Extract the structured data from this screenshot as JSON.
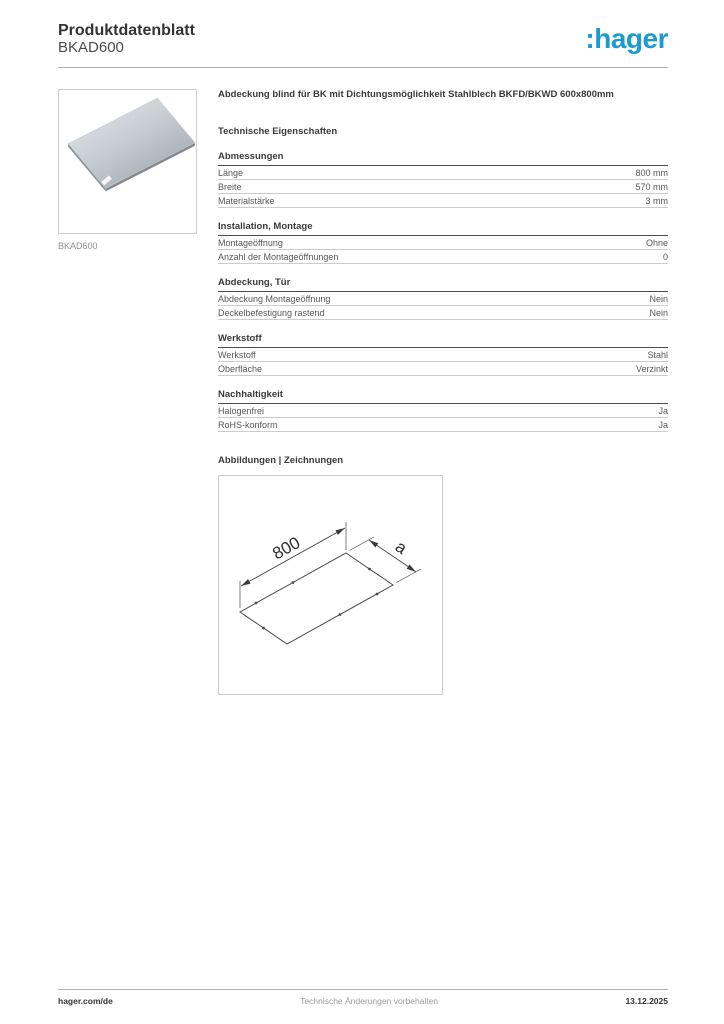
{
  "header": {
    "title": "Produktdatenblatt",
    "product_code": "BKAD600",
    "logo_text": ":hager"
  },
  "colors": {
    "logo_blue": "#1e9ad3",
    "text_dark": "#3c3c3c",
    "text_gray": "#9a9a9a",
    "rule_light": "#cccccc",
    "rule_dark": "#4d4d4d"
  },
  "product_image": {
    "caption": "BKAD600"
  },
  "description": "Abdeckung blind für BK mit Dichtungsmöglichkeit Stahlblech BKFD/BKWD 600x800mm",
  "tech_heading": "Technische Eigenschaften",
  "spec_sections": [
    {
      "title": "Abmessungen",
      "rows": [
        {
          "label": "Länge",
          "value": "800 mm"
        },
        {
          "label": "Breite",
          "value": "570 mm"
        },
        {
          "label": "Materialstärke",
          "value": "3 mm"
        }
      ]
    },
    {
      "title": "Installation, Montage",
      "rows": [
        {
          "label": "Montageöffnung",
          "value": "Ohne"
        },
        {
          "label": "Anzahl der Montageöffnungen",
          "value": "0"
        }
      ]
    },
    {
      "title": "Abdeckung, Tür",
      "rows": [
        {
          "label": "Abdeckung Montageöffnung",
          "value": "Nein"
        },
        {
          "label": "Deckelbefestigung rastend",
          "value": "Nein"
        }
      ]
    },
    {
      "title": "Werkstoff",
      "rows": [
        {
          "label": "Werkstoff",
          "value": "Stahl"
        },
        {
          "label": "Oberfläche",
          "value": "Verzinkt"
        }
      ]
    },
    {
      "title": "Nachhaltigkeit",
      "rows": [
        {
          "label": "Halogenfrei",
          "value": "Ja"
        },
        {
          "label": "RoHS-konform",
          "value": "Ja"
        }
      ]
    }
  ],
  "drawings": {
    "heading": "Abbildungen | Zeichnungen",
    "length_label": "800",
    "width_label": "a"
  },
  "footer": {
    "left": "hager.com/de",
    "center": "Technische Änderungen vorbehalten",
    "right": "13.12.2025"
  }
}
